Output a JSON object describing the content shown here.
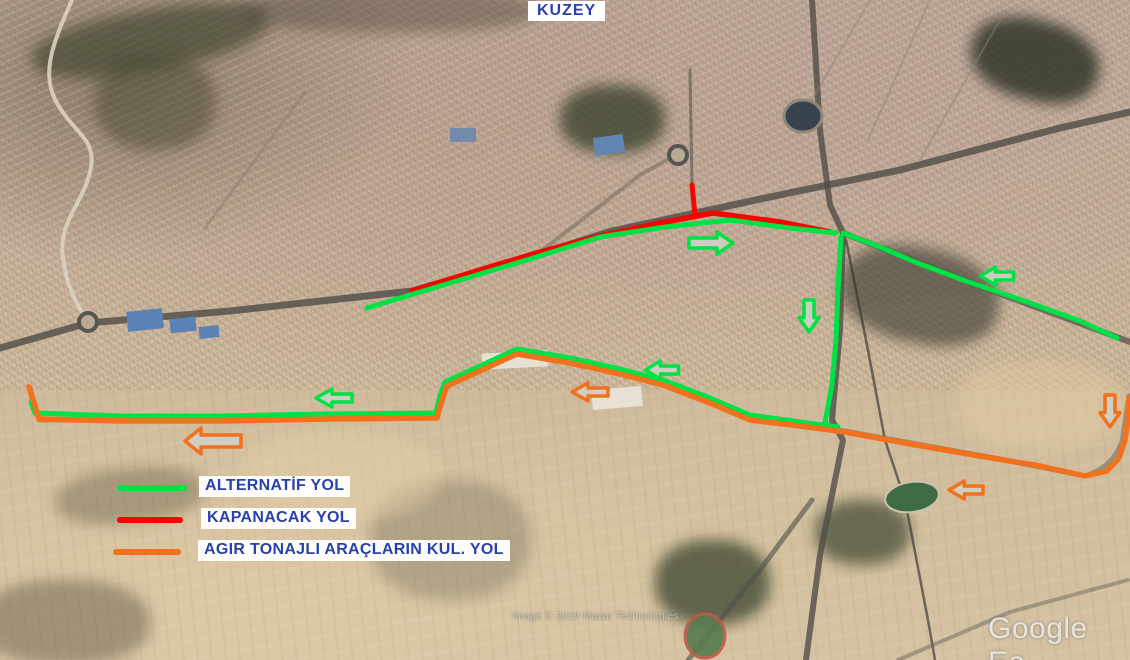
{
  "canvas": {
    "width": 1130,
    "height": 660
  },
  "colors": {
    "alternatif": "#00e145",
    "kapanacak": "#f50400",
    "agir_tonaj": "#f2711c",
    "legend_text": "#2742a8",
    "label_bg": "#ffffff",
    "arrow_fill": "rgba(206,208,197,0.9)"
  },
  "north_label": "KUZEY",
  "legend": {
    "items": [
      {
        "id": "alternatif",
        "label": "ALTERNATİF  YOL",
        "color_key": "alternatif"
      },
      {
        "id": "kapanacak",
        "label": "KAPANACAK  YOL",
        "color_key": "kapanacak"
      },
      {
        "id": "agir",
        "label": "AGIR TONAJLI ARAÇLARIN KUL. YOL",
        "color_key": "agir_tonaj"
      }
    ]
  },
  "watermark": {
    "brand": "Google Ea",
    "attribution": "Image © 2019 Maxar Technologies"
  },
  "map_annotations": {
    "routes": [
      {
        "id": "kapanacak-main",
        "legend": "KAPANACAK YOL",
        "color_key": "kapanacak",
        "width": 5.5,
        "points": [
          [
            412,
            291
          ],
          [
            470,
            273
          ],
          [
            540,
            252
          ],
          [
            600,
            236
          ],
          [
            660,
            223
          ],
          [
            713,
            213
          ],
          [
            780,
            222
          ],
          [
            830,
            232
          ]
        ]
      },
      {
        "id": "kapanacak-branch",
        "legend": "KAPANACAK YOL",
        "color_key": "kapanacak",
        "width": 5,
        "points": [
          [
            692,
            185
          ],
          [
            695,
            215
          ]
        ]
      },
      {
        "id": "alternatif-upper",
        "legend": "ALTERNATİF YOL",
        "color_key": "alternatif",
        "width": 5,
        "points": [
          [
            367,
            308
          ],
          [
            440,
            286
          ],
          [
            530,
            259
          ],
          [
            600,
            237
          ],
          [
            665,
            227
          ],
          [
            730,
            220
          ],
          [
            790,
            228
          ],
          [
            836,
            233
          ]
        ]
      },
      {
        "id": "alternatif-right",
        "legend": "ALTERNATİF YOL",
        "color_key": "alternatif",
        "width": 5,
        "points": [
          [
            843,
            233
          ],
          [
            880,
            247
          ],
          [
            915,
            262
          ],
          [
            963,
            280
          ],
          [
            1030,
            303
          ],
          [
            1080,
            321
          ],
          [
            1117,
            338
          ]
        ]
      },
      {
        "id": "alternatif-vertical",
        "legend": "ALTERNATİF YOL",
        "color_key": "alternatif",
        "width": 5,
        "points": [
          [
            841,
            237
          ],
          [
            838,
            290
          ],
          [
            836,
            340
          ],
          [
            832,
            385
          ],
          [
            827,
            412
          ],
          [
            825,
            422
          ],
          [
            831,
            427
          ]
        ]
      },
      {
        "id": "alternatif-loop",
        "legend": "ALTERNATİF YOL",
        "color_key": "alternatif",
        "width": 5,
        "points": [
          [
            31,
            402
          ],
          [
            35,
            413
          ],
          [
            120,
            416
          ],
          [
            220,
            416
          ],
          [
            330,
            414
          ],
          [
            436,
            413
          ],
          [
            440,
            396
          ],
          [
            445,
            382
          ],
          [
            480,
            366
          ],
          [
            517,
            349
          ],
          [
            570,
            358
          ],
          [
            620,
            369
          ],
          [
            663,
            380
          ],
          [
            710,
            398
          ],
          [
            750,
            415
          ],
          [
            800,
            422
          ],
          [
            838,
            427
          ]
        ]
      },
      {
        "id": "agir-tonajli",
        "legend": "AGIR TONAJLI ARAÇLARIN KUL. YOL",
        "color_key": "agir_tonaj",
        "width": 5.5,
        "points": [
          [
            29,
            387
          ],
          [
            34,
            403
          ],
          [
            39,
            419
          ],
          [
            120,
            421
          ],
          [
            220,
            421
          ],
          [
            330,
            419
          ],
          [
            437,
            418
          ],
          [
            442,
            400
          ],
          [
            447,
            386
          ],
          [
            517,
            354
          ],
          [
            570,
            363
          ],
          [
            620,
            374
          ],
          [
            663,
            385
          ],
          [
            710,
            403
          ],
          [
            750,
            420
          ],
          [
            800,
            426
          ],
          [
            845,
            432
          ],
          [
            910,
            444
          ],
          [
            980,
            456
          ],
          [
            1040,
            466
          ],
          [
            1085,
            476
          ],
          [
            1107,
            471
          ],
          [
            1119,
            458
          ],
          [
            1125,
            440
          ],
          [
            1128,
            420
          ],
          [
            1129,
            398
          ]
        ]
      }
    ],
    "arrows": [
      {
        "id": "green-right",
        "color_key": "alternatif",
        "x": 711,
        "y": 243,
        "dir": "right",
        "len": 44,
        "shaft": 5,
        "head": 11
      },
      {
        "id": "green-down",
        "color_key": "alternatif",
        "x": 809,
        "y": 316,
        "dir": "down",
        "len": 32,
        "shaft": 5,
        "head": 10
      },
      {
        "id": "green-left-ne",
        "color_key": "alternatif",
        "x": 997,
        "y": 276,
        "dir": "left",
        "len": 33,
        "shaft": 4,
        "head": 9
      },
      {
        "id": "green-left-mid",
        "color_key": "alternatif",
        "x": 662,
        "y": 370,
        "dir": "left",
        "len": 33,
        "shaft": 4,
        "head": 9
      },
      {
        "id": "green-left-w",
        "color_key": "alternatif",
        "x": 334,
        "y": 398,
        "dir": "left",
        "len": 36,
        "shaft": 4,
        "head": 9
      },
      {
        "id": "orange-left-mid",
        "color_key": "agir_tonaj",
        "x": 590,
        "y": 392,
        "dir": "left",
        "len": 36,
        "shaft": 4,
        "head": 9
      },
      {
        "id": "orange-left-w",
        "color_key": "agir_tonaj",
        "x": 213,
        "y": 441,
        "dir": "left",
        "len": 56,
        "shaft": 6,
        "head": 13
      },
      {
        "id": "orange-left-se",
        "color_key": "agir_tonaj",
        "x": 966,
        "y": 490,
        "dir": "left",
        "len": 34,
        "shaft": 4,
        "head": 9
      },
      {
        "id": "orange-down",
        "color_key": "agir_tonaj",
        "x": 1110,
        "y": 411,
        "dir": "down",
        "len": 32,
        "shaft": 5,
        "head": 10
      }
    ]
  }
}
